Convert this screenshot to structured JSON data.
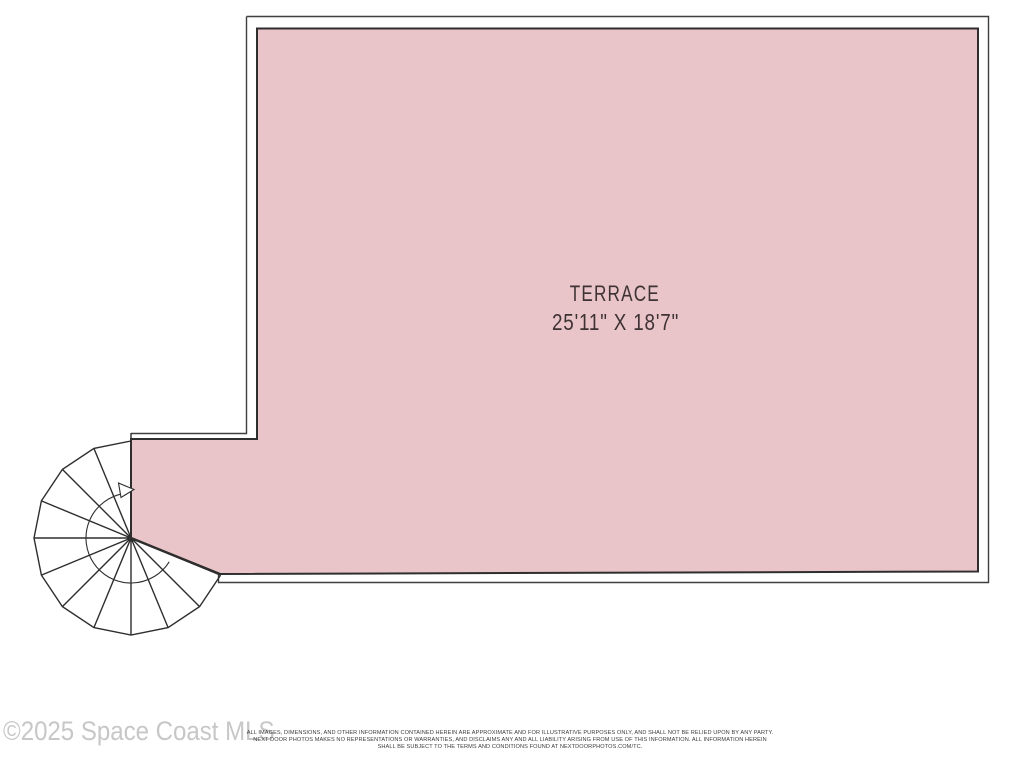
{
  "floorplan": {
    "room": {
      "label": "TERRACE",
      "dimensions": "25'11\" X 18'7\"",
      "fill_color": "#e9c4c8",
      "border_color": "#2e2e2e",
      "wall_color": "#3f3f3f",
      "feature": "spiral staircase with up-direction arrow at lower-left corner"
    }
  },
  "watermark": "©2025 Space Coast MLS",
  "disclaimer": {
    "line1": "ALL IMAGES, DIMENSIONS, AND OTHER INFORMATION CONTAINED HEREIN ARE APPROXIMATE AND FOR ILLUSTRATIVE PURPOSES ONLY, AND SHALL NOT BE RELIED UPON BY ANY PARTY.",
    "line2": "NEXT DOOR PHOTOS MAKES NO REPRESENTATIONS OR WARRANTIES, AND DISCLAIMS ANY AND ALL LIABILITY ARISING FROM USE OF THIS INFORMATION. ALL INFORMATION HEREIN",
    "line3": "SHALL BE SUBJECT TO THE TERMS AND CONDITIONS FOUND AT NEXTDOORPHOTOS.COM/TC."
  }
}
